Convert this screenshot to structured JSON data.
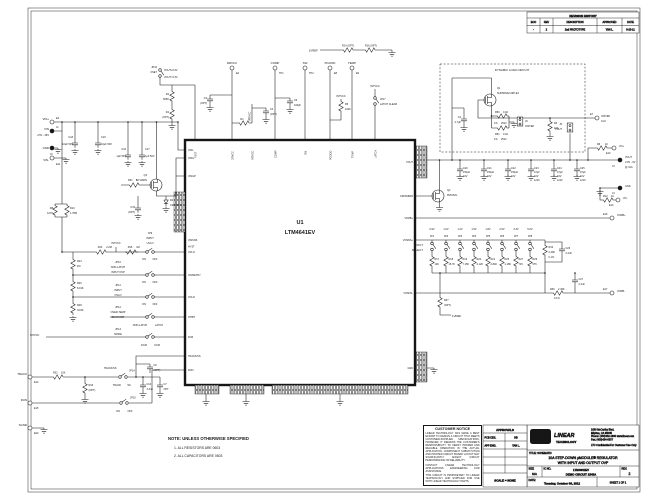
{
  "rev": {
    "title": "REVISION HISTORY",
    "c1": "ECO",
    "c2": "REV",
    "c3": "DESCRIPTION",
    "c4": "APPROVED",
    "c5": "DATE",
    "r1": "-",
    "r2": "2",
    "r3": "2nd PROTOTYPE",
    "r4": "YAN L.",
    "r5": "9-23-11"
  },
  "notice": {
    "title": "CUSTOMER NOTICE",
    "p1": "LINEAR TECHNOLOGY HAS MADE A BEST EFFORT TO DESIGN A CIRCUIT THAT MEETS CUSTOMER-SUPPLIED SPECIFICATIONS; HOWEVER, IT REMAINS THE CUSTOMER'S RESPONSIBILITY TO VERIFY PROPER AND RELIABLE OPERATION IN THE ACTUAL APPLICATION. COMPONENT SUBSTITUTION AND PRINTED CIRCUIT BOARD LAYOUT MAY SIGNIFICANTLY AFFECT CIRCUIT PERFORMANCE OR RELIABILITY.",
    "p2": "CONTACT LINEAR TECHNOLOGY APPLICATIONS ENGINEERING FOR ASSISTANCE.",
    "p3": "THIS CIRCUIT IS PROPRIETARY TO LINEAR TECHNOLOGY AND SUPPLIED FOR USE WITH LINEAR TECHNOLOGY PARTS."
  },
  "approvals": {
    "title": "APPROVALS",
    "r1l": "PCB DES.",
    "r1v": "HB",
    "r2l": "APP ENG.",
    "r2v": "YAN L.",
    "scale": "SCALE = NONE"
  },
  "tb": {
    "logo": "LT",
    "company": "LINEAR",
    "company2": "TECHNOLOGY",
    "addr1": "1630 McCarthy Blvd.",
    "addr2": "Milpitas, CA 95035",
    "addr3": "Phone: (408)432-1900   www.linear.com",
    "addr4": "Fax: (408)434-0507",
    "conf": "LTC Confidential-For Customer Use Only",
    "title_label": "TITLE: SCHEMATIC",
    "title1": "10A STEP-DOWN µMODULE® REGULATOR",
    "title2": "WITH INPUT AND OUTPUT OVP",
    "size_l": "SIZE",
    "size_v": "N/A",
    "icno_l": "IC NO.",
    "ic1": "LTM4641EV",
    "ic2": "DEMO CIRCUIT 1543A",
    "rev_l": "REV.",
    "rev_v": "2",
    "date_l": "DATE:",
    "date_v": "Tuesday, October 09, 2012",
    "sheet": "SHEET  1  OF  1"
  },
  "note": {
    "title": "NOTE: UNLESS OTHERWISE SPECIFIED",
    "n1": "1. ALL RESISTORS ARE 0603",
    "n2": "2. ALL CAPACITORS ARE 0603"
  },
  "ic": {
    "ref": "U1",
    "part": "LTM4641EV",
    "left": [
      "VINL",
      "VING",
      "VINGP",
      "VINSNS",
      "HYST",
      "UVLO",
      "IOVRETRY",
      "OVLO",
      "OTBH",
      "FCB",
      "TRACK/SS",
      "RUN"
    ],
    "top": [
      "FSET",
      "DRVCC",
      "INTVCC",
      "COMP",
      "SW",
      "PGOOD",
      "TEMP",
      "LATCH"
    ],
    "right": [
      "VOUT",
      "CROWBAR",
      "VORB+",
      "VOSNS+",
      "VOSNS-",
      "GND"
    ]
  },
  "sel": {
    "t1": "VOUT",
    "t2": "SELECT",
    "v": [
      "0.9V",
      "1.0V",
      "1.2V",
      "1.5V",
      "1.8V",
      "2.5V",
      "3.3V",
      "5.0V"
    ],
    "jp": [
      "JP1",
      "JP2",
      "JP3",
      "JP4",
      "JP5",
      "JP6",
      "JP7",
      "JP8"
    ],
    "r": [
      "R17",
      "R18",
      "R19",
      "R20",
      "R21",
      "R25",
      "R27",
      "R29"
    ],
    "rv": [
      "10K",
      "15.7K",
      "7.15K",
      "4.12K",
      "2.84K",
      "1.18K",
      "715",
      "576"
    ]
  },
  "L": {
    "vinp": "VIN+",
    "e3": "E3",
    "vin": "VIN",
    "vinrange": "4.5V - 38V",
    "j1": "J1",
    "gndl": "GND",
    "j2": "J2",
    "vinm": "VIN-",
    "e11": "E11",
    "c18": "C18",
    "c19": "C19",
    "v10u50": "10µF 50V",
    "c16": "C16",
    "c17": "C17",
    "v1u50": "1µF 50V",
    "q3": "Q3",
    "q3p": "Si7114DN",
    "r31": "R31",
    "one": "1",
    "d2": "D2",
    "d2p": "CMDSH-3",
    "c15": "C15",
    "opt": "(OPT)",
    "optw": "OPT",
    "r8": "R8",
    "r8v": "107K",
    "r10": "R10",
    "r10v": "1.78M",
    "r24": "R24",
    "v1m": "1M",
    "r26": "R26",
    "r26v": "8.19K",
    "r28": "R28",
    "r28v": "34.8K",
    "r13": "R13",
    "r13v": "2.2M",
    "r15": "R15",
    "intvcc": "INTVCC",
    "jp9": "JP9",
    "input": "INPUT",
    "uvlo": "UVLO",
    "on": "ON",
    "off": "OFF",
    "jp10": "JP10",
    "nonlatch": "NON-LATCH",
    "inputovp": "INPUT OVP",
    "jp11": "JP11",
    "ovlo": "OVLO",
    "jp12": "JP12",
    "overtemp": "OVER-TEMP",
    "behavior": "BEHAVIOR",
    "latch": "LATCH",
    "jp13": "JP13",
    "mode": "MODE",
    "dcm": "DCM",
    "ccm": "CCM",
    "jp16": "JP16",
    "fset": "FSET",
    "fseta": "VOUT≤3.3V",
    "fsetb": "VOUT>3.3V",
    "r2": "R2",
    "r2v": "665K",
    "r4": "R4",
    "e2": "E2",
    "drvcc": "DRVCC",
    "tp1": "TP1",
    "comp": "COMP",
    "tp2": "TP2",
    "sw": "SW",
    "e8": "E8",
    "pgood": "PGOOD",
    "e9": "E9",
    "temp": "TEMP",
    "c3": "C3",
    "r1": "R1",
    "c4": "C4",
    "c6": "C6",
    "c6v": "100pF",
    "r5": "R5",
    "r5v": "100K",
    "jp17": "JP17",
    "latchclear": "LATCH CLEAR",
    "vref": "1VREF",
    "r14o": "R14 (OPT)",
    "r16o": "R16 (OPT)",
    "dlc": "DYNAMIC LOAD CIRCUIT",
    "q1": "Q1",
    "q1p": "SUD50N02-09P-E3",
    "c2": "C2",
    "c2v": "4.7µF",
    "r3": "R3",
    "r3v": "10K",
    "j6": "J6",
    "iostep": "IOSTEP",
    "e7": "E7",
    "clk": "CLK",
    "r50": "R50",
    "r51": "R51",
    "r002": "0.02",
    "pct1": "1%",
    "p2512": "2512",
    "c20": "C20",
    "c21": "C21",
    "c22": "C22",
    "v150": "150µF",
    "v10": "10V",
    "c23": "C23",
    "c24": "C24",
    "c25": "C25",
    "v47": "47µF",
    "p1210": "1210",
    "q2": "Q2",
    "q2p": "PMOSXL",
    "j5": "J5",
    "vout": "VOUT",
    "r6": "R6",
    "ten": "10",
    "e10": "E10",
    "vop": "VO+",
    "j3": "J3",
    "voutrange": "0.9V - 6V",
    "vouta": "@ 10A",
    "j4": "J4",
    "r12": "R12",
    "e13": "E13",
    "vom": "VO-",
    "e16": "E16",
    "vorbp": "VORB+",
    "e17": "E17",
    "vorbm": "VORB-",
    "r34": "R34",
    "r249": "2.49K",
    "pct01": "0.1%",
    "c26": "C26",
    "c27": "C27",
    "v22n": "2.2nF",
    "r36": "R36",
    "r37": "R37",
    "e14": "E14",
    "track": "TRACK",
    "r32": "R32",
    "r32v": "10K",
    "r33": "R33",
    "trackss": "TRACK/SS",
    "jp14": "JP14",
    "ss": "SS",
    "c10": "C10",
    "c10v": "3.3nF",
    "c7": "C7",
    "c9": "C9",
    "e15": "E15",
    "run": "RUN",
    "jp15": "JP15",
    "e20": "E20",
    "sgnd": "SGND"
  }
}
